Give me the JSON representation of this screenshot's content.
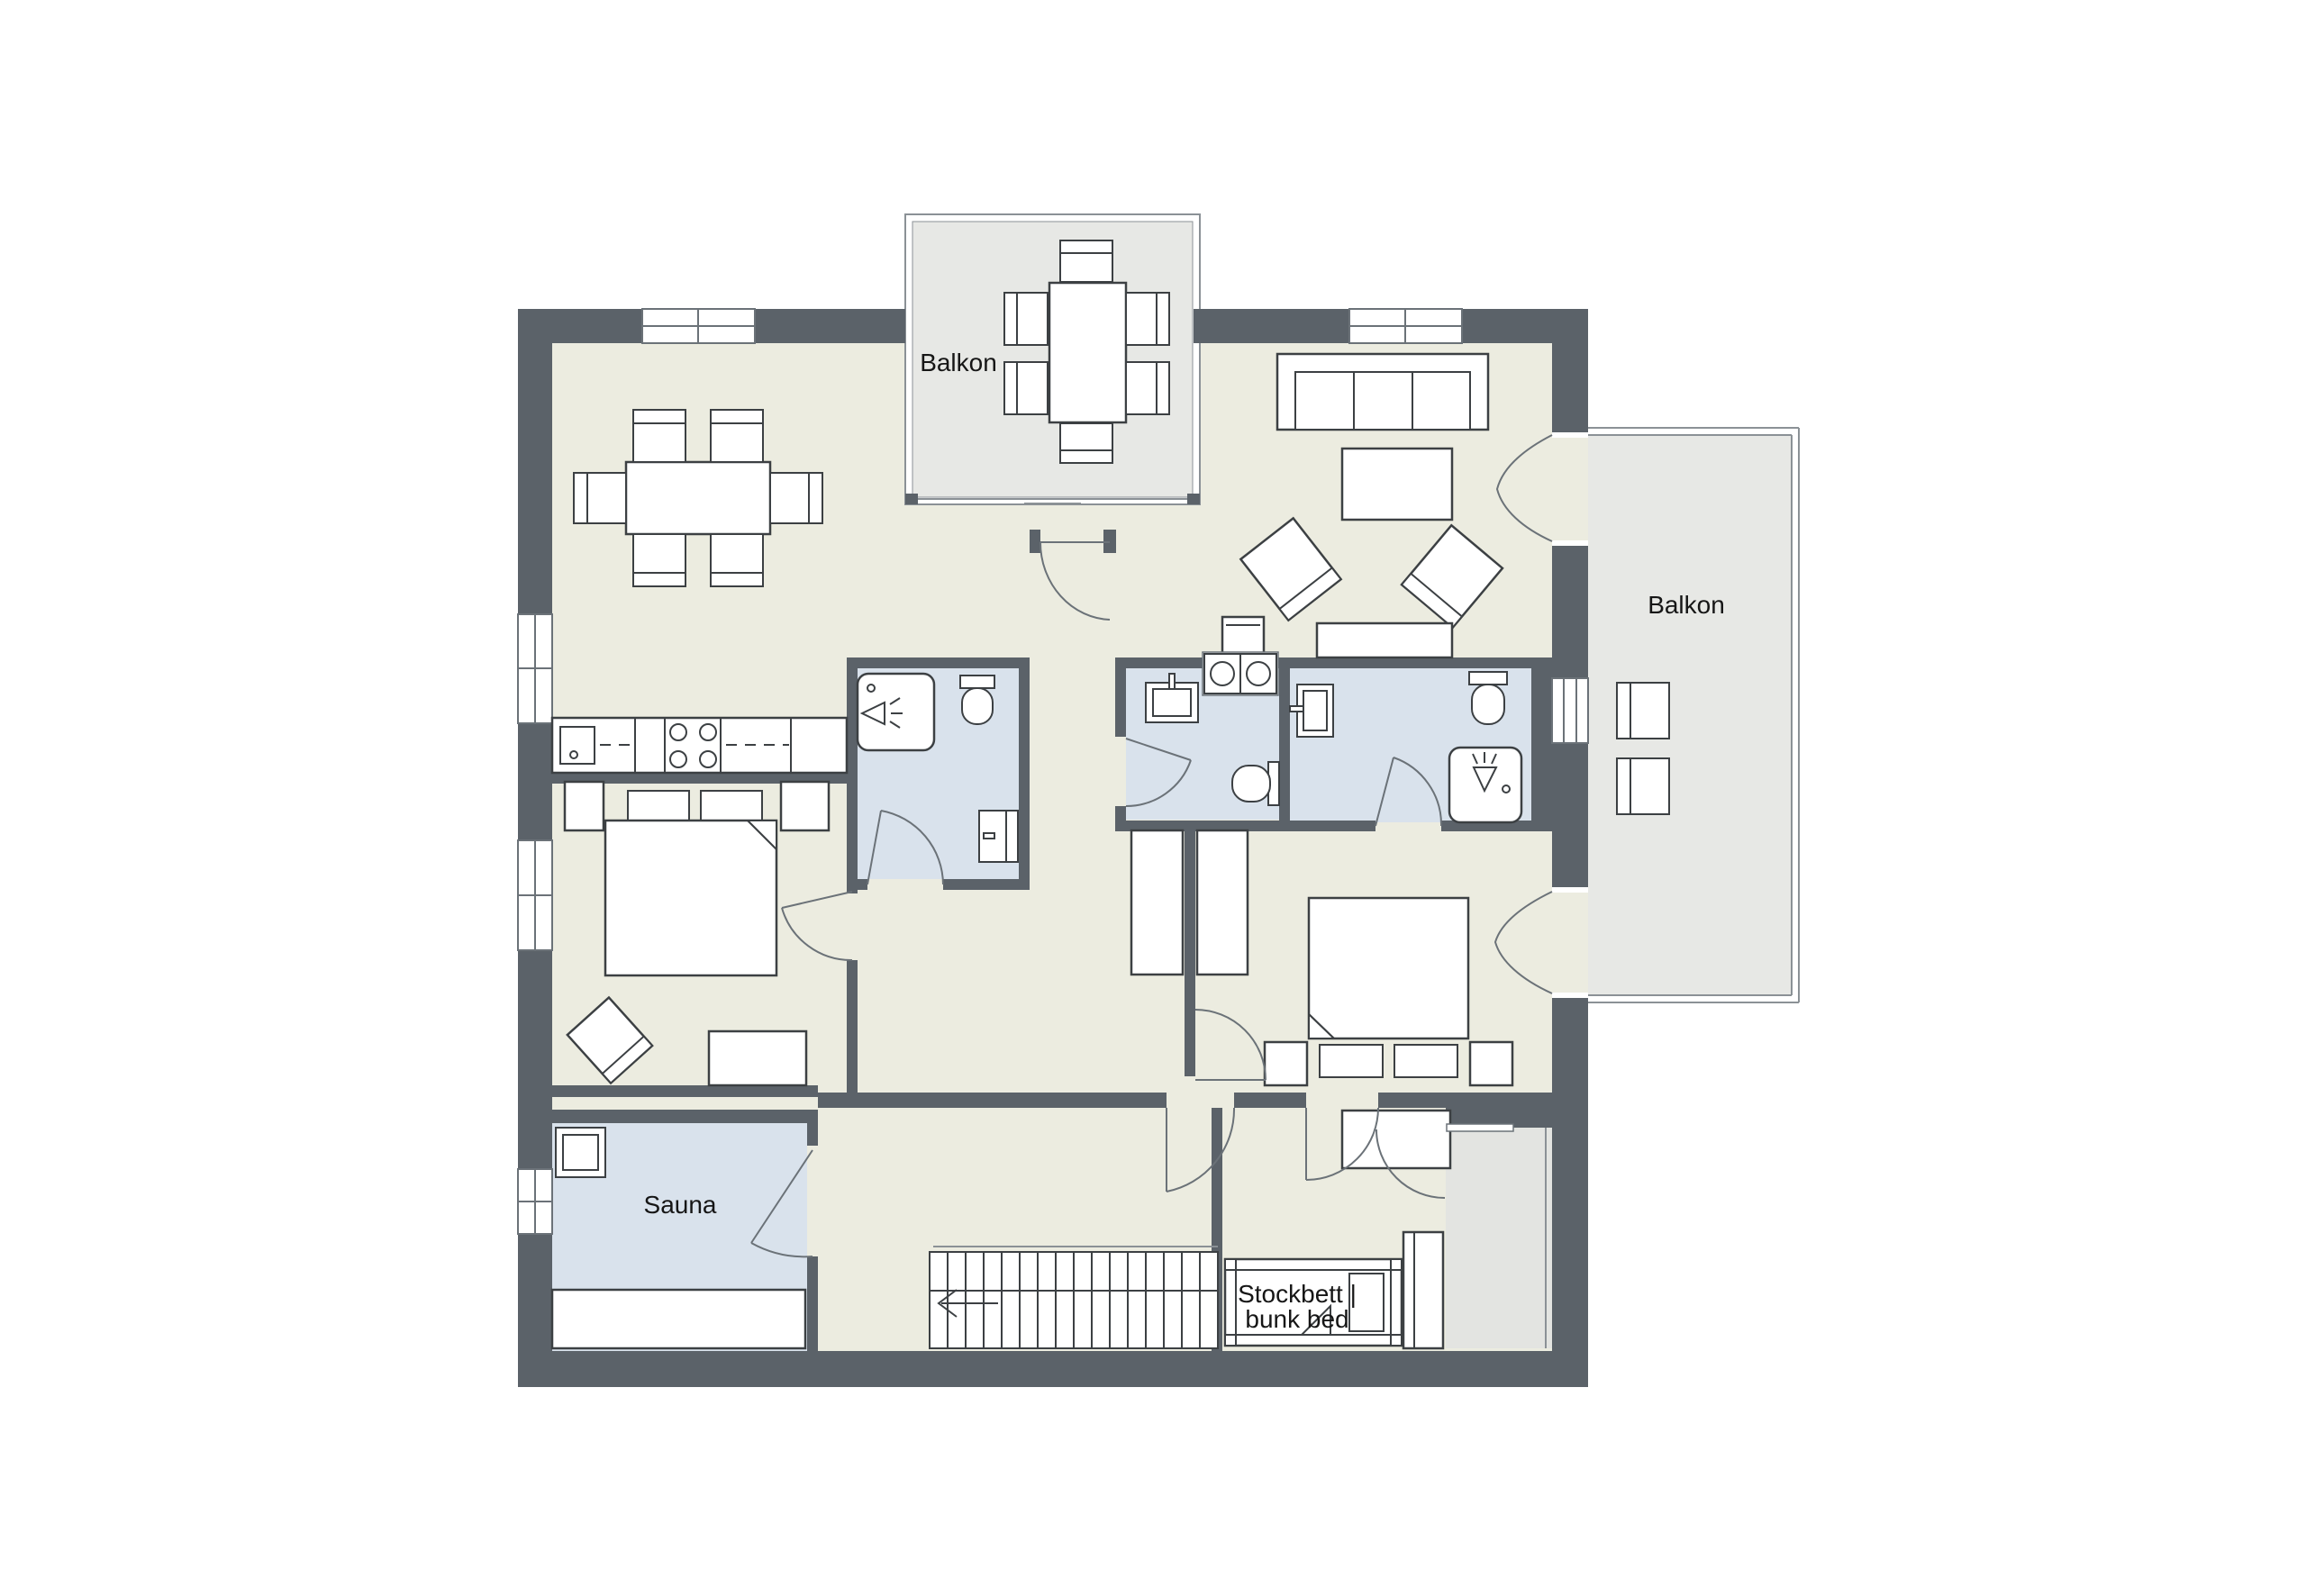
{
  "labels": {
    "balcony_top": "Balkon",
    "balcony_right": "Balkon",
    "sauna": "Sauna",
    "bunk_bed_line1": "Stockbett |",
    "bunk_bed_line2": "bunk bed"
  },
  "colors": {
    "wall": "#5b6269",
    "floor": "#ecece0",
    "wet_room": "#d9e2ec",
    "balcony": "#e7e8e5",
    "utility_area": "#e3e4e1",
    "furniture_outline": "#3c4043",
    "label_text": "#161616",
    "background": "#ffffff"
  }
}
